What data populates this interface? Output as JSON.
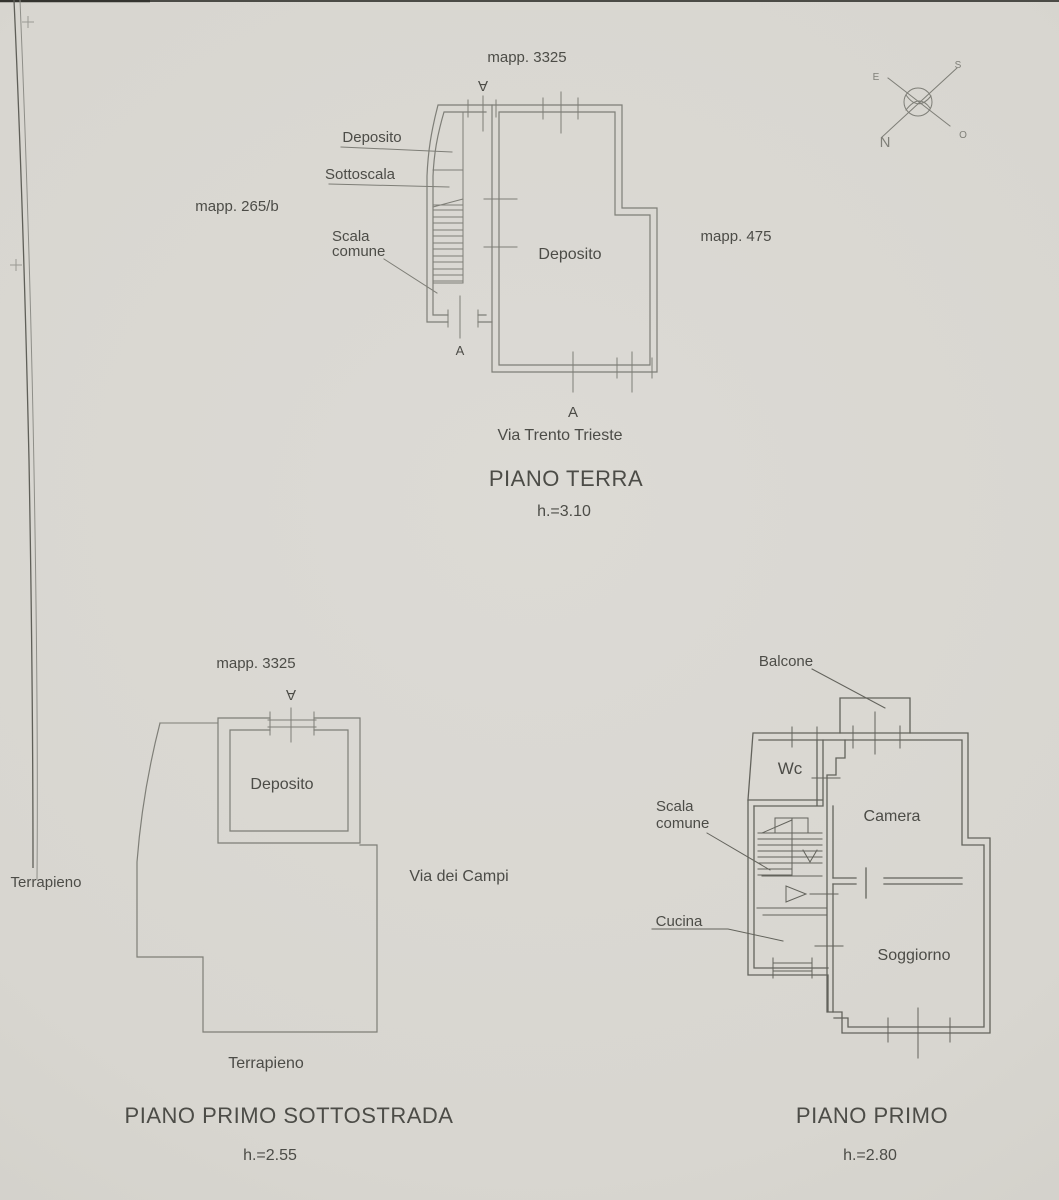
{
  "compass": {
    "n": "N",
    "s": "S",
    "e": "E",
    "o": "O"
  },
  "piano_terra": {
    "mapp_top": "mapp. 3325",
    "mapp_left": "mapp. 265/b",
    "mapp_right": "mapp. 475",
    "deposito_small": "Deposito",
    "sottoscala": "Sottoscala",
    "scala_line1": "Scala",
    "scala_line2": "comune",
    "deposito_main": "Deposito",
    "street": "Via Trento Trieste",
    "title": "PIANO TERRA",
    "height": "h.=3.10",
    "section_mark": "A"
  },
  "piano_sottostrada": {
    "mapp": "mapp. 3325",
    "deposito": "Deposito",
    "terrapieno_left": "Terrapieno",
    "terrapieno_bottom": "Terrapieno",
    "street": "Via dei Campi",
    "title": "PIANO PRIMO SOTTOSTRADA",
    "height": "h.=2.55",
    "section_mark": "A"
  },
  "piano_primo": {
    "balcone": "Balcone",
    "wc": "Wc",
    "camera": "Camera",
    "scala_line1": "Scala",
    "scala_line2": "comune",
    "cucina": "Cucina",
    "soggiorno": "Soggiorno",
    "title": "PIANO PRIMO",
    "height": "h.=2.80",
    "section_mark": "A"
  }
}
